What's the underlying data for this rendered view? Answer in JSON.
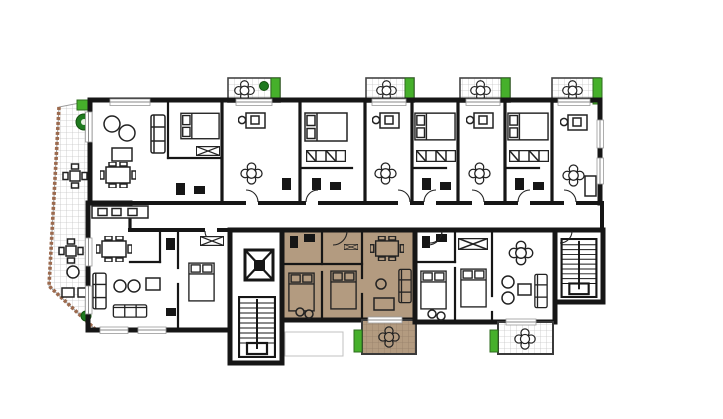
{
  "plan": {
    "kind": "architectural-floor-plan",
    "highlighted_unit": {
      "name": "apartment-highlighted",
      "fill": "#b39b80"
    },
    "areas": [
      {
        "name": "terrace-wraparound-left"
      },
      {
        "name": "apartment-top-left"
      },
      {
        "name": "apartment-studio-1"
      },
      {
        "name": "apartment-bedroom-1"
      },
      {
        "name": "apartment-studio-2"
      },
      {
        "name": "apartment-bedroom-2"
      },
      {
        "name": "apartment-studio-3"
      },
      {
        "name": "apartment-bedroom-3"
      },
      {
        "name": "apartment-studio-4"
      },
      {
        "name": "corridor"
      },
      {
        "name": "apartment-bottom-left"
      },
      {
        "name": "elevator-stair-core"
      },
      {
        "name": "apartment-highlighted"
      },
      {
        "name": "apartment-bottom-right"
      },
      {
        "name": "stairwell-right"
      },
      {
        "name": "balcony-top-1"
      },
      {
        "name": "balcony-top-2"
      },
      {
        "name": "balcony-top-3"
      },
      {
        "name": "balcony-top-4"
      },
      {
        "name": "balcony-bottom-highlighted"
      },
      {
        "name": "balcony-bottom-right"
      }
    ]
  },
  "colors": {
    "background": "#ffffff",
    "wall": "#161616",
    "line": "#222222",
    "floor_white": "#ffffff",
    "highlight_fill": "#b39b80",
    "highlight_grid": "#97816a",
    "tile_line": "#c6c6c6",
    "planter_green": "#46b02b",
    "plant_green": "#1f7a1f",
    "terrace_edge": "#9c6a4e",
    "faint_line": "#c0c0c0"
  }
}
